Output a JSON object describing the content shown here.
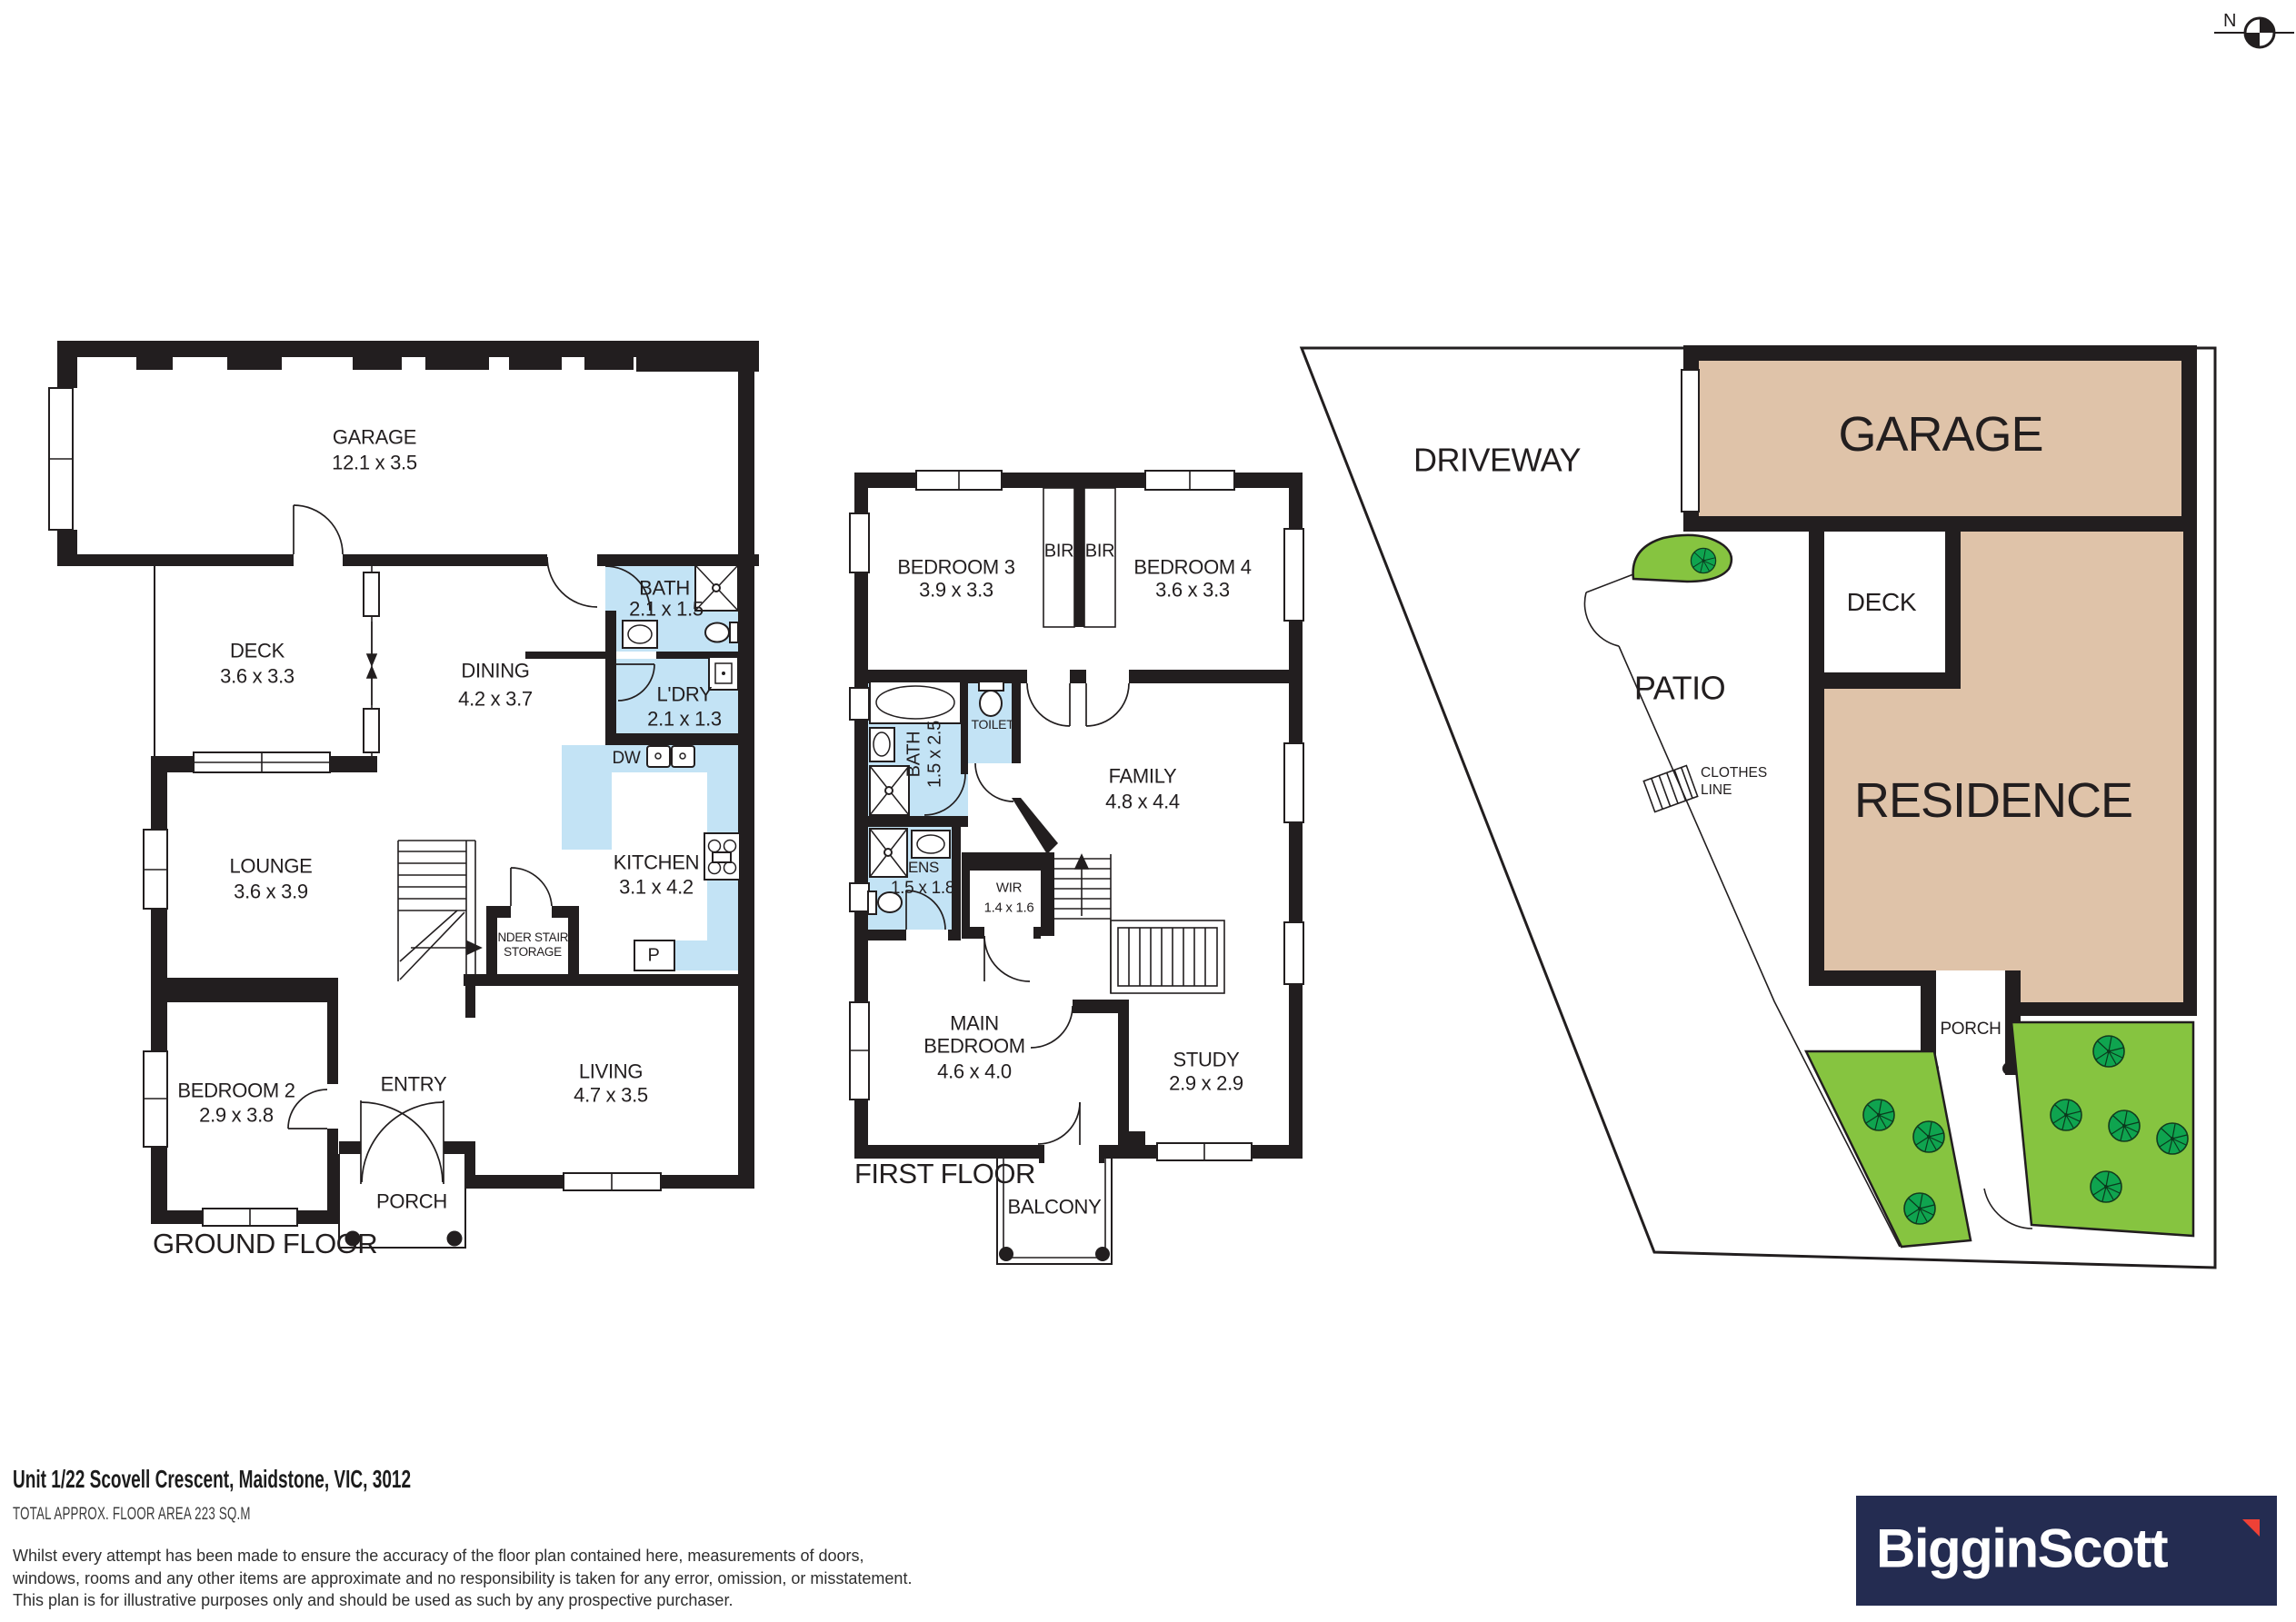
{
  "compass": {
    "north_label": "N"
  },
  "ground_floor": {
    "floor_label": "GROUND FLOOR",
    "rooms": {
      "garage": {
        "name": "GARAGE",
        "size": "12.1 x 3.5"
      },
      "deck": {
        "name": "DECK",
        "size": "3.6 x 3.3"
      },
      "dining": {
        "name": "DINING",
        "size": "4.2 x 3.7"
      },
      "bath": {
        "name": "BATH",
        "size": "2.1 x 1.5"
      },
      "laundry": {
        "name": "L'DRY",
        "size": "2.1 x 1.3"
      },
      "kitchen": {
        "name": "KITCHEN",
        "size": "3.1 x 4.2"
      },
      "lounge": {
        "name": "LOUNGE",
        "size": "3.6 x 3.9"
      },
      "bedroom2": {
        "name": "BEDROOM 2",
        "size": "2.9 x 3.8"
      },
      "living": {
        "name": "LIVING",
        "size": "4.7 x 3.5"
      },
      "entry": {
        "name": "ENTRY"
      },
      "porch": {
        "name": "PORCH"
      },
      "under_stairs": {
        "name": "UNDER STAIRS STORAGE"
      },
      "dishwasher": {
        "name": "DW"
      },
      "pantry": {
        "name": "P"
      }
    }
  },
  "first_floor": {
    "floor_label": "FIRST FLOOR",
    "rooms": {
      "bedroom3": {
        "name": "BEDROOM 3",
        "size": "3.9 x 3.3"
      },
      "bedroom4": {
        "name": "BEDROOM 4",
        "size": "3.6 x 3.3"
      },
      "bir_left": {
        "name": "BIR"
      },
      "bir_right": {
        "name": "BIR"
      },
      "bath": {
        "name": "BATH",
        "size": "1.5 x 2.5"
      },
      "toilet": {
        "name": "TOILET"
      },
      "family": {
        "name": "FAMILY",
        "size": "4.8 x 4.4"
      },
      "ens": {
        "name": "ENS",
        "size": "1.5 x 1.8"
      },
      "wir": {
        "name": "WIR",
        "size": "1.4 x 1.6"
      },
      "main_bedroom": {
        "name": "MAIN BEDROOM",
        "size": "4.6 x 4.0"
      },
      "study": {
        "name": "STUDY",
        "size": "2.9 x 2.9"
      },
      "balcony": {
        "name": "BALCONY"
      }
    }
  },
  "site_plan": {
    "labels": {
      "driveway": "DRIVEWAY",
      "garage": "GARAGE",
      "deck": "DECK",
      "patio": "PATIO",
      "residence": "RESIDENCE",
      "clothes_line": "CLOTHES LINE",
      "porch": "PORCH"
    }
  },
  "footer": {
    "address": "Unit 1/22 Scovell Crescent, Maidstone, VIC, 3012",
    "area_label": "TOTAL APPROX. FLOOR AREA 223 SQ.M",
    "disclaimer": [
      "Whilst every attempt has been made to ensure the accuracy of the floor plan contained here, measurements of doors,",
      "windows, rooms and any other items are approximate and no responsibility is taken for any error, omission, or misstatement.",
      "This plan is for illustrative purposes only and should be used as such by any prospective purchaser."
    ]
  },
  "logo": {
    "brand": "BigginScott"
  },
  "colors": {
    "wall": "#221E1F",
    "wet_area_blue": "#C3E3F5",
    "site_building_tan": "#DFC3A9",
    "lawn_green": "#86C440",
    "tree_green": "#0FA44F",
    "brand_navy": "#242C51",
    "brand_red": "#EE4136"
  }
}
